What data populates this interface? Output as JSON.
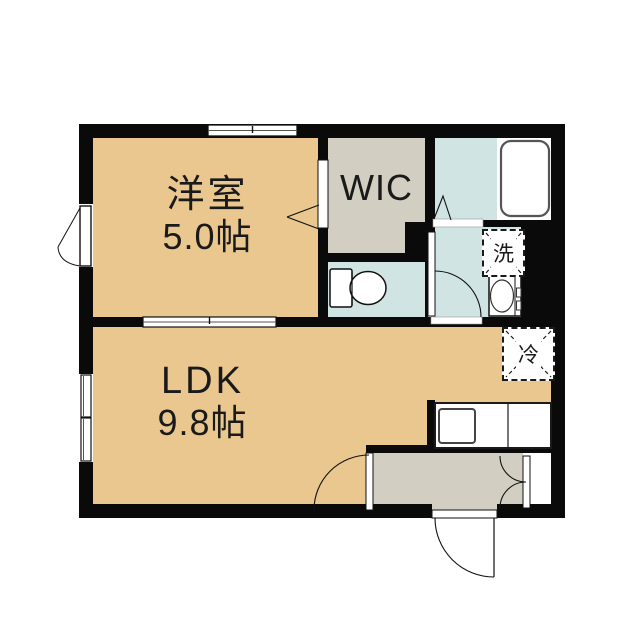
{
  "floorplan": {
    "type": "apartment-floor-plan-1LDK",
    "rooms": {
      "western_room": {
        "name": "洋室",
        "size": "5.0帖"
      },
      "ldk": {
        "name": "LDK",
        "size": "9.8帖"
      },
      "wic": {
        "label": "WIC"
      }
    },
    "fixtures": {
      "washer_pan": {
        "label": "洗"
      },
      "refrigerator_space": {
        "label": "冷"
      }
    },
    "colors": {
      "wall": "#0a0a0a",
      "room_tan": "#e9c78f",
      "room_gray": "#d2cfc2",
      "room_blue": "#d1e4e4",
      "fixture_white": "#ffffff"
    }
  }
}
